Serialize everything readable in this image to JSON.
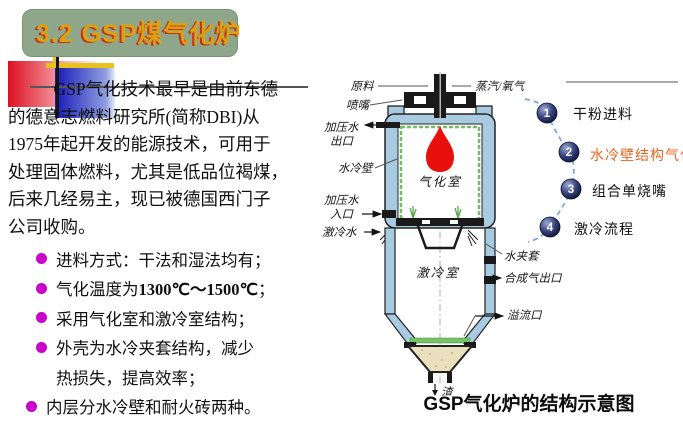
{
  "title": "3.2  GSP煤气化炉",
  "intro": {
    "lines": [
      "GSP气化技术最早是由前东德",
      "的德意志燃料研究所(简称DBI)从",
      "1975年起开发的能源技术，可用于",
      "处理固体燃料，尤其是低品位褐煤，",
      "后来几经易主，现已被德国西门子",
      "公司收购。"
    ]
  },
  "bullets": {
    "b1": "进料方式：干法和湿法均有；",
    "b2_pre": "气化温度为",
    "b2_bold": "1300℃～1500℃",
    "b2_post": "；",
    "b3": "采用气化室和激冷室结构；",
    "b4_line1": "外壳为水冷夹套结构，减少",
    "b4_line2": "热损失，提高效率；",
    "b5": "内层分水冷壁和耐火砖两种。"
  },
  "diagram": {
    "labels": {
      "raw_material": "原料",
      "steam_oxygen": "蒸汽/氧气",
      "nozzle": "喷嘴",
      "press_water_out_1": "加压水",
      "press_water_out_2": "出口",
      "water_wall": "水冷壁",
      "press_water_in_1": "加压水",
      "press_water_in_2": "入口",
      "quench_water": "激冷水",
      "gasification_chamber": "气化室",
      "quench_chamber": "激冷室",
      "water_jacket": "水夹套",
      "syngas_outlet": "合成气出口",
      "overflow_port": "溢流口",
      "slag": "渣"
    },
    "steps": [
      {
        "num": "1",
        "label": "干粉进料"
      },
      {
        "num": "2",
        "label": "水冷壁结构气化炉"
      },
      {
        "num": "3",
        "label": "组合单烧嘴"
      },
      {
        "num": "4",
        "label": "激冷流程"
      }
    ],
    "caption": "GSP气化炉的结构示意图"
  },
  "colors": {
    "title_bg": "#8EA78A",
    "title_text": "#D9A215",
    "title_shadow": "#C23217",
    "bullet_dot": "#CC00CC",
    "step_highlight": "#E8641E",
    "flame": "#E8100C",
    "vessel_shell": "#A9CBE2",
    "lining_green": "#74BD66",
    "slag_sand": "#EBE0BE",
    "sphere_navy": "#2E3B78",
    "dash_curve": "#7FA8D9"
  }
}
